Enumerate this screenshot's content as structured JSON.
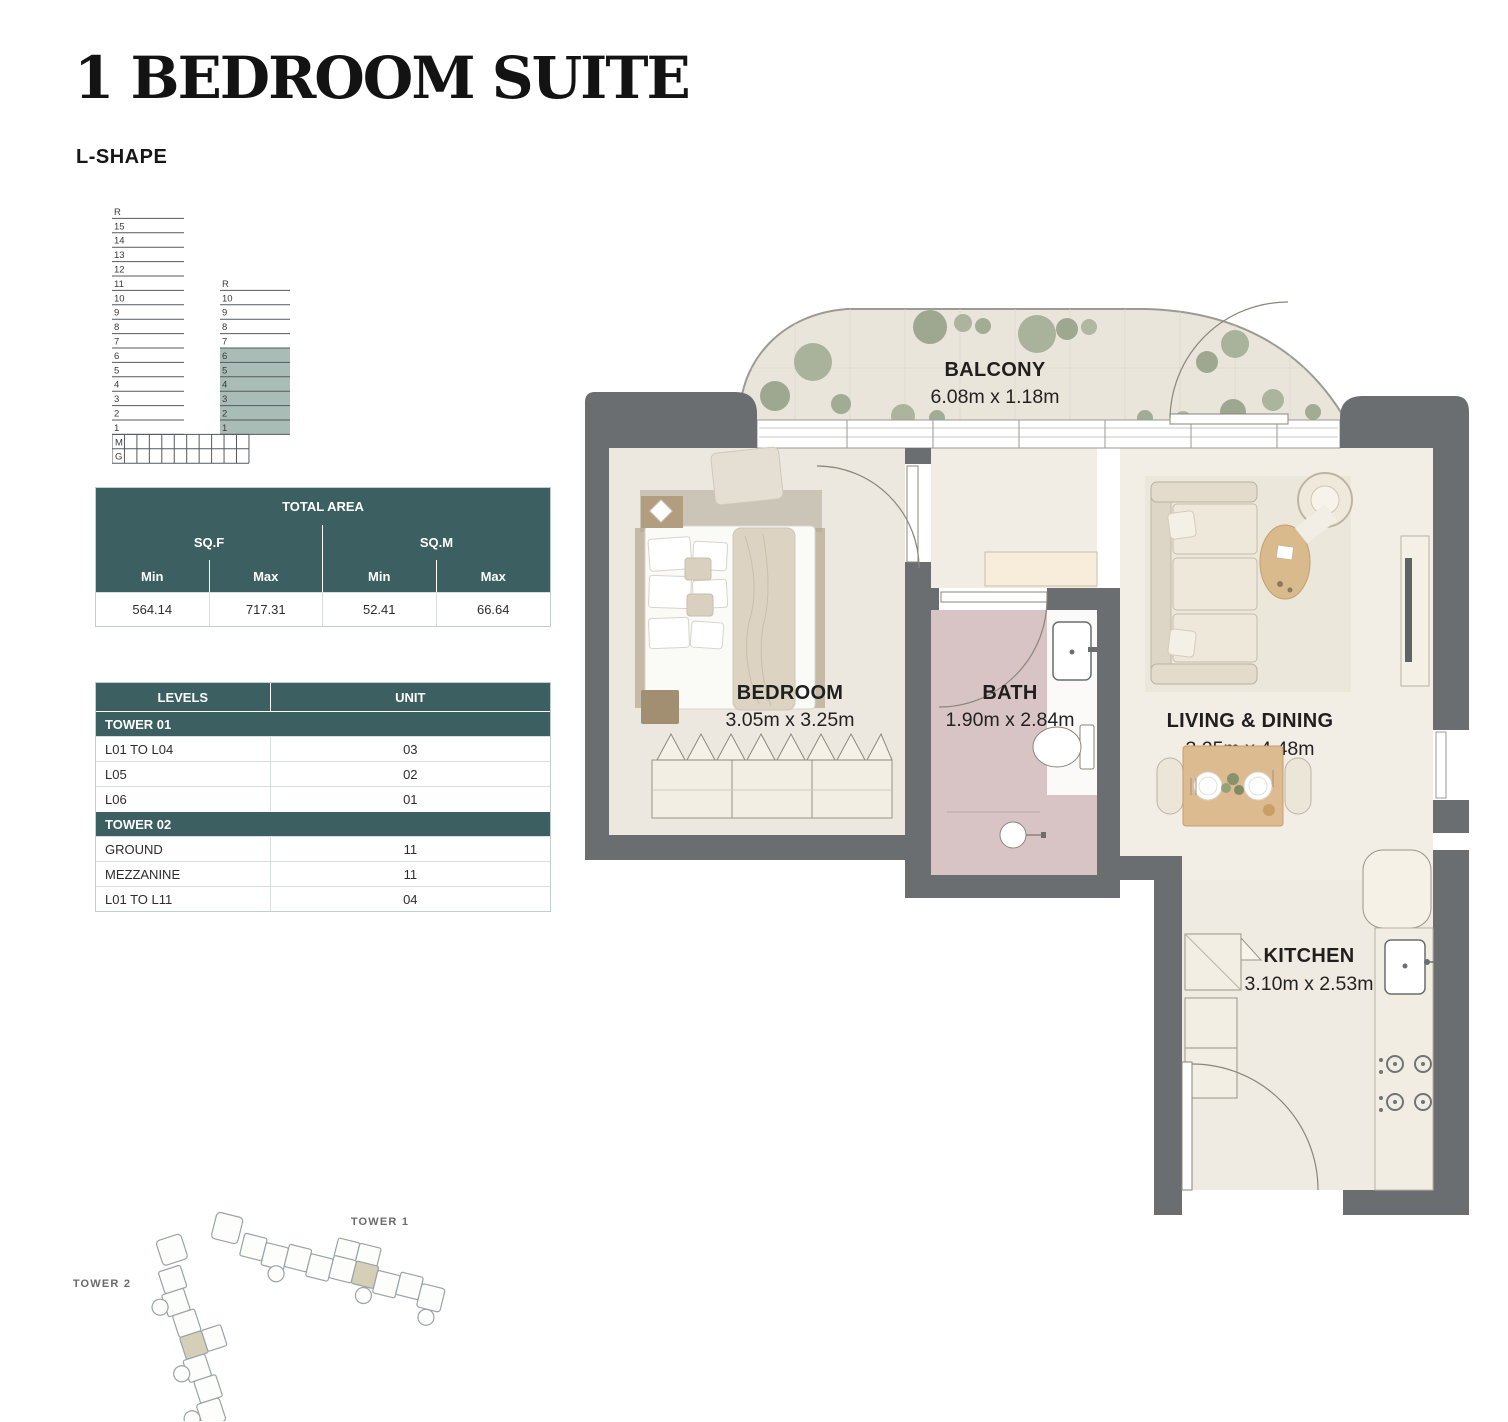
{
  "page": {
    "title": "1 BEDROOM SUITE",
    "subtitle": "L-SHAPE"
  },
  "stack_diagram": {
    "tall_tower_floors": [
      "R",
      "15",
      "14",
      "13",
      "12",
      "11",
      "10",
      "9",
      "8",
      "7",
      "6",
      "5",
      "4",
      "3",
      "2",
      "1"
    ],
    "podium_floors": [
      "M",
      "G"
    ],
    "short_tower_floors": [
      "R",
      "10",
      "9",
      "8",
      "7",
      "6",
      "5",
      "4",
      "3",
      "2",
      "1"
    ],
    "highlighted_floors": [
      "6",
      "5",
      "4",
      "3",
      "2",
      "1"
    ],
    "highlight_color": "#a9bcb6"
  },
  "total_area": {
    "title": "TOTAL AREA",
    "unit_groups": [
      "SQ.F",
      "SQ.M"
    ],
    "col_headers": [
      "Min",
      "Max",
      "Min",
      "Max"
    ],
    "values": [
      "564.14",
      "717.31",
      "52.41",
      "66.64"
    ]
  },
  "levels_table": {
    "headers": [
      "LEVELS",
      "UNIT"
    ],
    "sections": [
      {
        "name": "TOWER 01",
        "rows": [
          [
            "L01 TO L04",
            "03"
          ],
          [
            "L05",
            "02"
          ],
          [
            "L06",
            "01"
          ]
        ]
      },
      {
        "name": "TOWER 02",
        "rows": [
          [
            "GROUND",
            "11"
          ],
          [
            "MEZZANINE",
            "11"
          ],
          [
            "L01 TO L11",
            "04"
          ]
        ]
      }
    ]
  },
  "floor_plan": {
    "rooms": [
      {
        "name": "BALCONY",
        "dims": "6.08m x 1.18m"
      },
      {
        "name": "BEDROOM",
        "dims": "3.05m x 3.25m"
      },
      {
        "name": "BATH",
        "dims": "1.90m x 2.84m"
      },
      {
        "name": "LIVING & DINING",
        "dims": "3.25m x 4.48m"
      },
      {
        "name": "KITCHEN",
        "dims": "3.10m x 2.53m"
      }
    ]
  },
  "site_plan": {
    "tower1_label": "TOWER 1",
    "tower2_label": "TOWER 2"
  },
  "colors": {
    "teal": "#3c6061",
    "highlight": "#a9bcb6",
    "wall": "#6a6e71",
    "bath_floor": "#d9c4c5",
    "balcony_floor": "#e9e5da"
  }
}
